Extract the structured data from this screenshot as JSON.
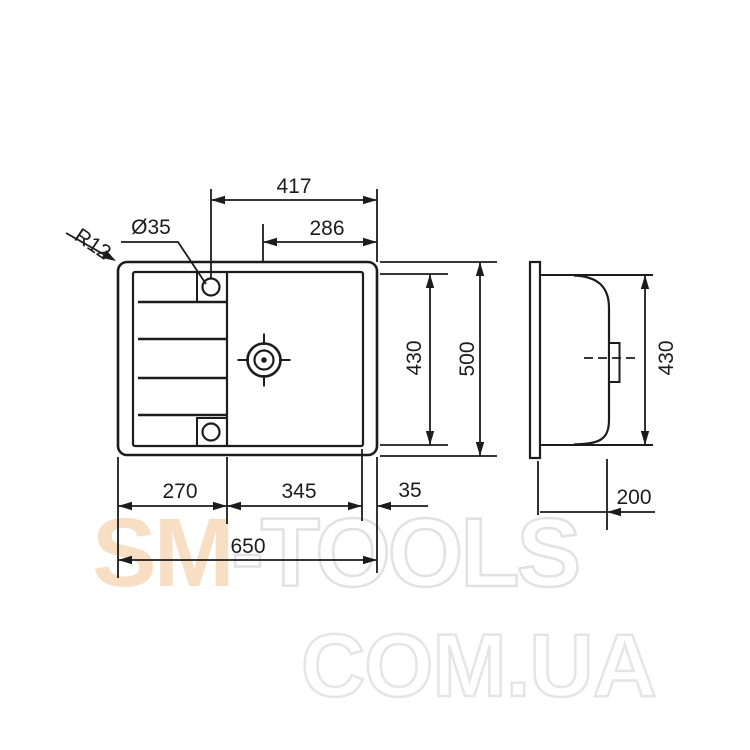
{
  "drawing": {
    "dims": {
      "top_width": "417",
      "drain_center_offset": "286",
      "hole_diameter": "Ø35",
      "corner_radius": "R12",
      "inner_depth": "430",
      "outer_depth": "500",
      "drainboard_width": "270",
      "bowl_width": "345",
      "right_margin": "35",
      "overall_width": "650",
      "side_height": "430",
      "bowl_depth": "200"
    },
    "colors": {
      "line": "#1c1c1c",
      "watermark_accent": "#f8dfc4",
      "watermark_outline": "#e2e2e2"
    }
  },
  "watermark": {
    "brand_left": "SM",
    "brand_right": "-TOOLS",
    "domain": "COM.UA"
  }
}
